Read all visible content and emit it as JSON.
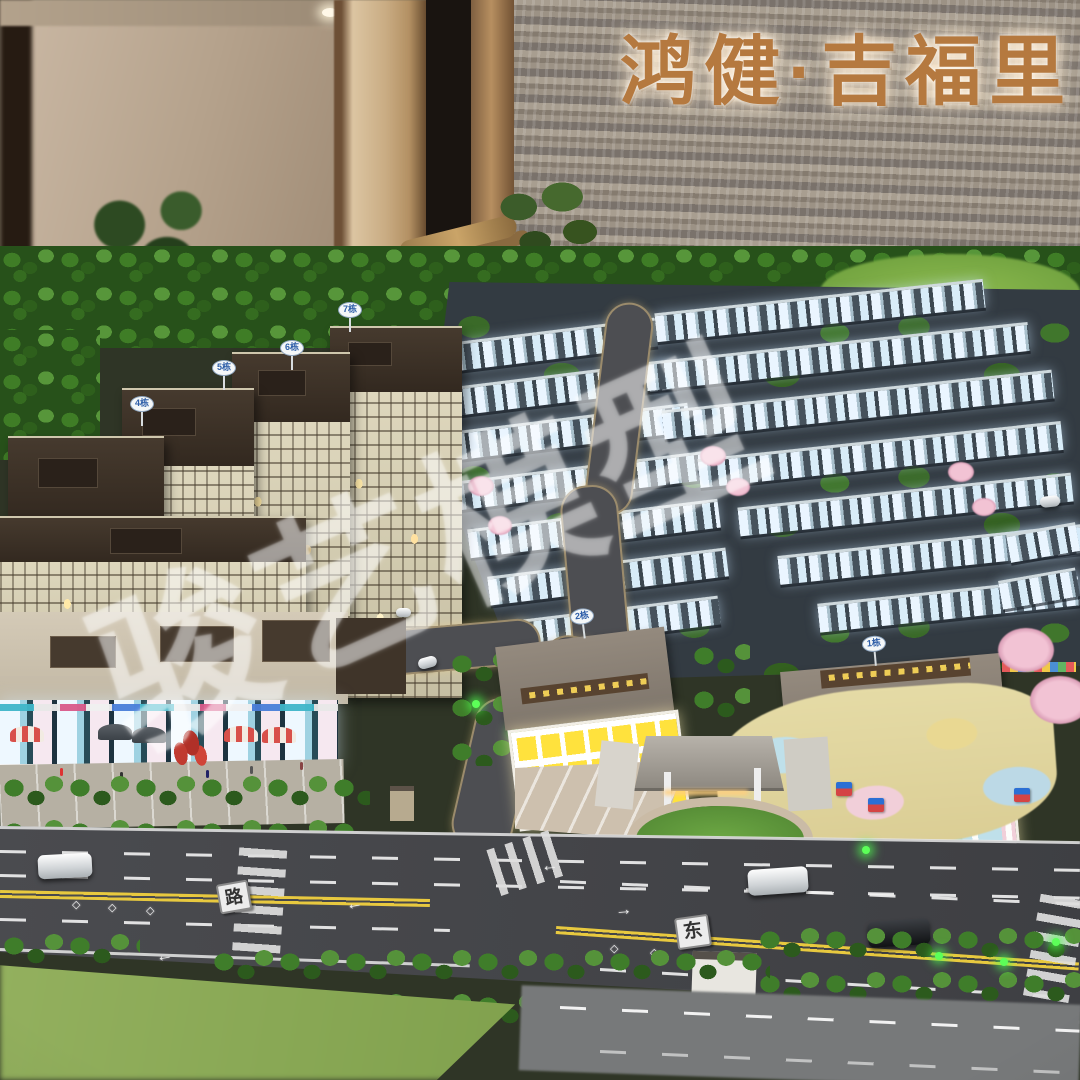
{
  "scene": {
    "signboard": {
      "text": "鸿健·吉福里",
      "color": "#b5793f"
    },
    "watermark": {
      "text": "骏艺模型",
      "opacity": 0.34
    },
    "road_name_plates": [
      {
        "text": "路"
      },
      {
        "text": "东"
      }
    ],
    "building_plates": [
      {
        "label": "7栋"
      },
      {
        "label": "6栋"
      },
      {
        "label": "5栋"
      },
      {
        "label": "4栋"
      },
      {
        "label": "2栋"
      },
      {
        "label": "1栋"
      }
    ],
    "road_markings": {
      "arrow": "↑",
      "diamond": "◇"
    },
    "colors": {
      "sign_bronze": "#b5793f",
      "marble_wall": "#93897c",
      "forest_green": "#3f7d26",
      "road_surface": "#45464a",
      "lane_yellow": "#e8c93f",
      "window_glow": "#eaf5ff",
      "kindergarten_yellow": "#ffe23d",
      "playground_pastels": [
        "#bfe0ea",
        "#f1cfd9",
        "#e9d892"
      ]
    }
  }
}
